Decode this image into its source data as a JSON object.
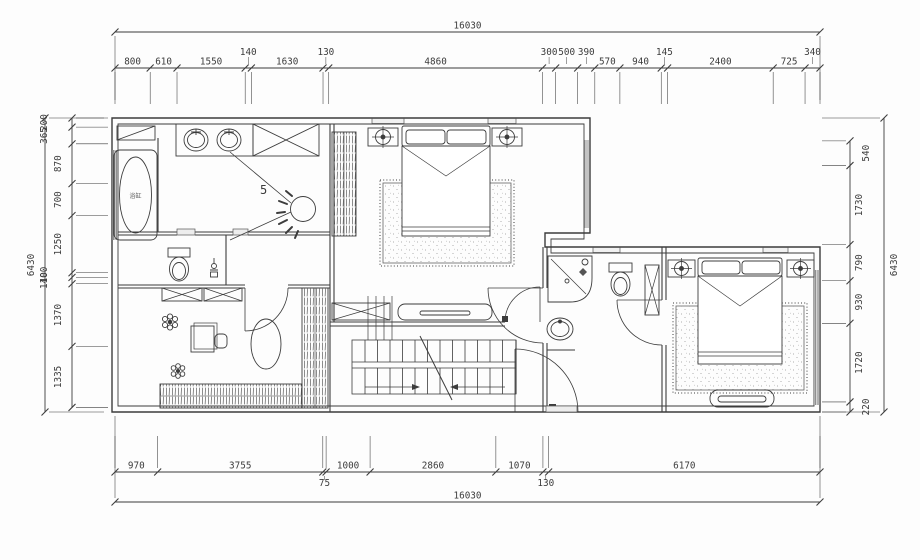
{
  "drawing": {
    "kind": "floor-plan"
  },
  "dimensions": {
    "top": {
      "total": "16030",
      "segments": [
        "800",
        "610",
        "1550",
        "140",
        "1630",
        "130",
        "4860",
        "300",
        "500",
        "390",
        "570",
        "940",
        "145",
        "2400",
        "725",
        "340"
      ]
    },
    "bottom": {
      "total": "16030",
      "segments": [
        "970",
        "3755",
        "75",
        "1000",
        "2860",
        "1070",
        "130",
        "6170"
      ]
    },
    "left": {
      "total": "6430",
      "segments": [
        "200",
        "365",
        "870",
        "700",
        "1250",
        "100",
        "140",
        "1370",
        "1335"
      ]
    },
    "right": {
      "total": "6430",
      "segments": [
        "540",
        "1730",
        "790",
        "930",
        "1720",
        "220"
      ]
    }
  },
  "labels": {
    "dressing_area_number": "5",
    "bathtub": "浴缸"
  },
  "colors": {
    "line": "#3c3c3c",
    "light": "#6a6a6a",
    "background": "#fdfdfd"
  }
}
